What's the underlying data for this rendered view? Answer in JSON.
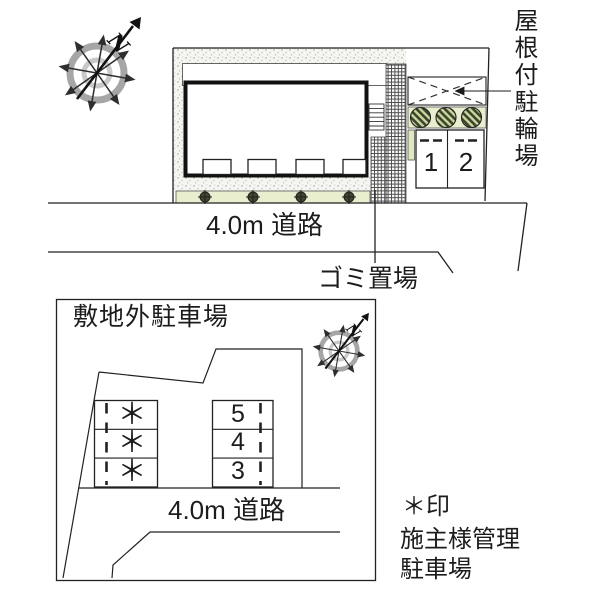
{
  "colors": {
    "line": "#222222",
    "building_wall": "#111111",
    "green_strip": "#e9efce",
    "green_strip2": "#dfe9c0",
    "bush_dark": "#44442f",
    "bush_leaf_bg": "#ccd89e",
    "bush_leaf_line": "#39422a",
    "crosshatch_line": "#4c4c4c",
    "stipple_dot": "#b8b8b2",
    "compass_ring_outer": "#a6a6a6",
    "compass_ring_inner": "#c9c9c9",
    "compass_arrow": "#2e2e2e"
  },
  "main_plan": {
    "compass_north_label": "N",
    "bicycle_parking_label": "屋根付駐輪場",
    "parking_space_labels": [
      "1",
      "2"
    ],
    "road_label": "4.0m 道路",
    "garbage_area_label": "ゴミ置場"
  },
  "offsite_plan": {
    "title": "敷地外駐車場",
    "compass_north_label": "N",
    "starred_space_labels": [
      "＊",
      "＊",
      "＊"
    ],
    "numbered_space_labels": [
      "5",
      "4",
      "3"
    ],
    "road_label": "4.0m 道路"
  },
  "legend": {
    "line1": "＊印",
    "line2": "施主様管理",
    "line3": "駐車場"
  }
}
